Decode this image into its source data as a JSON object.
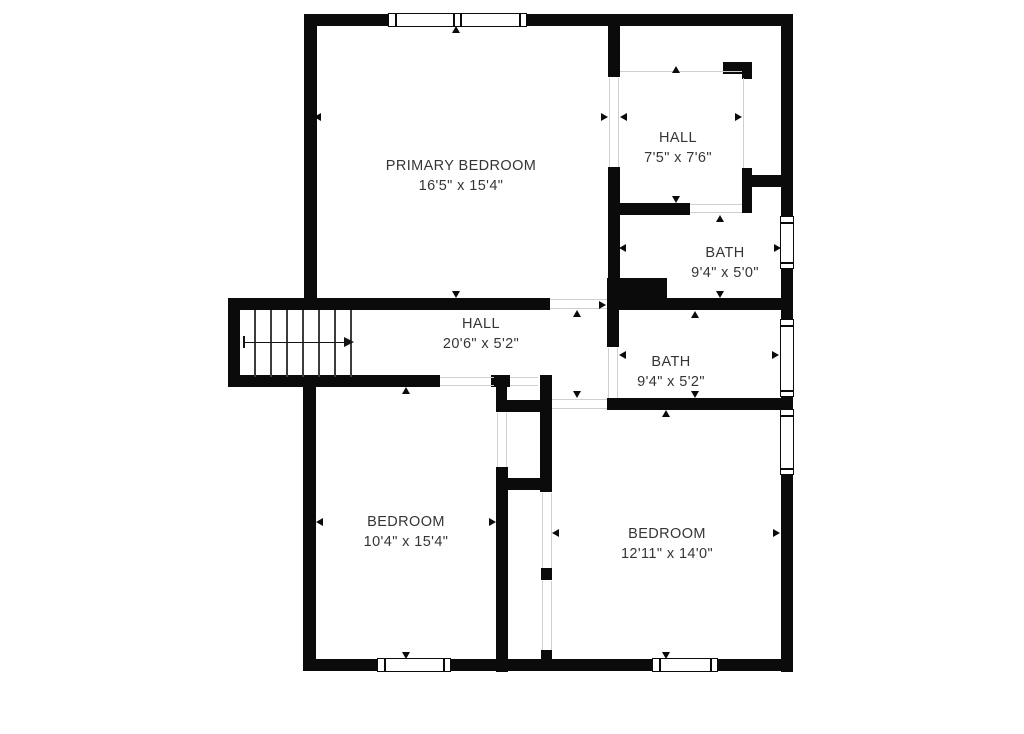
{
  "plan_title": "Second floor plan",
  "colors": {
    "wall": "#0b0b0b",
    "background": "#ffffff",
    "label_text": "#353535",
    "open_boundary_line": "#cfcfcf"
  },
  "rooms": [
    {
      "id": "primary-bedroom",
      "name": "PRIMARY BEDROOM",
      "size": "16'5\" x 15'4\""
    },
    {
      "id": "hall-upper",
      "name": "HALL",
      "size": "7'5\" x 7'6\""
    },
    {
      "id": "bath-upper",
      "name": "BATH",
      "size": "9'4\" x 5'0\""
    },
    {
      "id": "hall-main",
      "name": "HALL",
      "size": "20'6\" x 5'2\""
    },
    {
      "id": "bath-lower",
      "name": "BATH",
      "size": "9'4\" x 5'2\""
    },
    {
      "id": "bedroom-left",
      "name": "BEDROOM",
      "size": "10'4\" x 15'4\""
    },
    {
      "id": "bedroom-right",
      "name": "BEDROOM",
      "size": "12'11\" x 14'0\""
    }
  ],
  "stairs": {
    "tread_count": 7,
    "direction_arrow": "right"
  },
  "window_count": 6
}
